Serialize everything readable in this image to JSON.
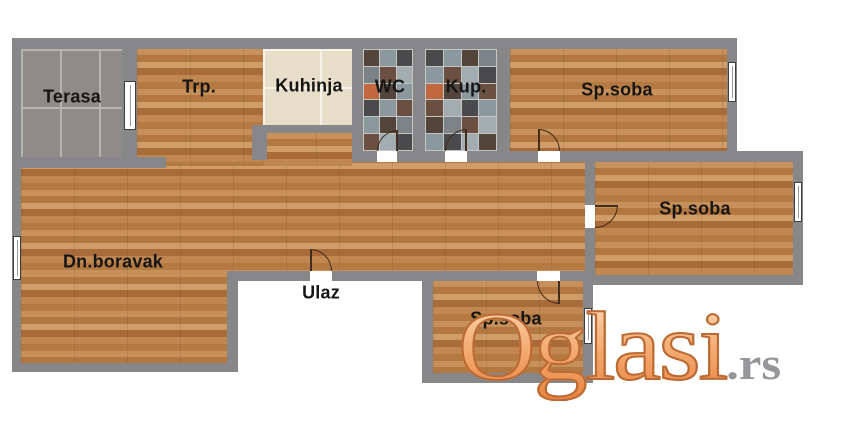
{
  "rooms": {
    "terasa": {
      "label": "Terasa"
    },
    "trpezarija": {
      "label": "Trp."
    },
    "kuhinja": {
      "label": "Kuhinja"
    },
    "wc": {
      "label": "WC"
    },
    "kupatilo": {
      "label": "Kup."
    },
    "sp_soba_top": {
      "label": "Sp.soba"
    },
    "sp_soba_middle": {
      "label": "Sp.soba"
    },
    "sp_soba_bottom": {
      "label": "Sp.soba"
    },
    "dnevni_boravak": {
      "label": "Dn.boravak"
    },
    "ulaz": {
      "label": "Ulaz"
    }
  },
  "watermark": {
    "brand": "Oglasi",
    "tld": ".rs"
  },
  "colors": {
    "wall": "#87878a",
    "wood_base": "#bd7f4b",
    "terrace_tile": "#8f8b88",
    "terrace_grout": "#b7b3ae",
    "kitchen_tile": "#e7ddc9",
    "mosaic_gap": "#c3c7c3",
    "watermark_orange": "#ef9a58",
    "watermark_outline": "#bb6a33",
    "watermark_tld_gray": "#96969a",
    "label_text": "#151515"
  },
  "mosaic": {
    "wc": {
      "cols": 3,
      "tiles": [
        [
          "#53453c",
          "#8b989e",
          "#4a4a4c"
        ],
        [
          "#7b8388",
          "#6b4f41",
          "#a3adb1"
        ],
        [
          "#c26840",
          "#53453c",
          "#8b989e"
        ],
        [
          "#4a4a4c",
          "#8b989e",
          "#6b4f41"
        ],
        [
          "#8b989e",
          "#53453c",
          "#7b8388"
        ],
        [
          "#6b4f41",
          "#a3adb1",
          "#4a4a4c"
        ]
      ]
    },
    "kup": {
      "cols": 4,
      "tiles": [
        [
          "#4a4a4c",
          "#8b989e",
          "#53453c",
          "#7b8388"
        ],
        [
          "#8b989e",
          "#6b4f41",
          "#a3adb1",
          "#4a4a4c"
        ],
        [
          "#c26840",
          "#53453c",
          "#8b989e",
          "#6b4f41"
        ],
        [
          "#6b4f41",
          "#a3adb1",
          "#4a4a4c",
          "#8b989e"
        ],
        [
          "#53453c",
          "#7b8388",
          "#6b4f41",
          "#a3adb1"
        ],
        [
          "#8b989e",
          "#4a4a4c",
          "#a3adb1",
          "#53453c"
        ]
      ]
    }
  }
}
